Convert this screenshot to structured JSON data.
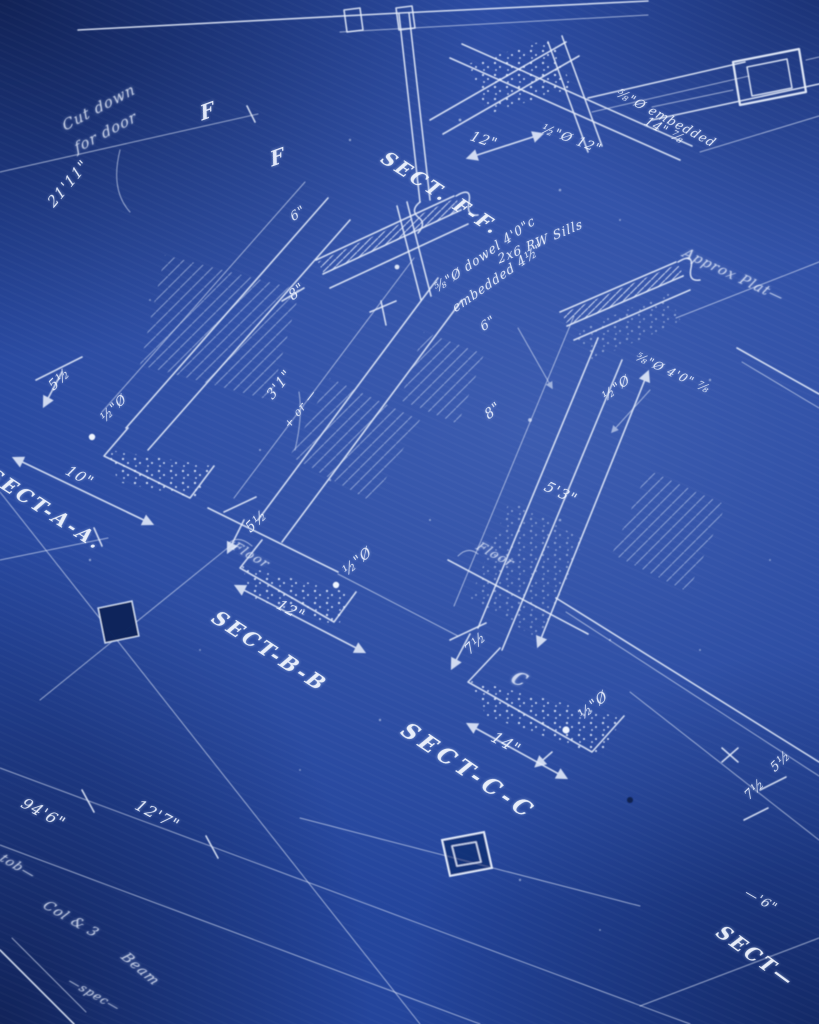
{
  "image": {
    "kind": "photograph of a hand-drawn cyanotype construction blueprint",
    "paper_color": "#24459c",
    "highlight_color": "#3a5cb2",
    "shadow_color": "#12295e",
    "line_color": "#e7eefc"
  },
  "sections": {
    "ff": "SECT. F-F.",
    "aa": "SECT-A-A.",
    "bb": "SECT-B-B",
    "cc": "SECT-C-C",
    "partial": "SECT—"
  },
  "markers": {
    "f1": "F",
    "f2": "F",
    "c": "C"
  },
  "notes": {
    "cut1": "Cut down",
    "cut2": "for door",
    "sills": "2x6 RW Sills",
    "dowel1": "⅝\"Ø dowel 4'0\"c",
    "dowel2": "embedded 4½\"",
    "embed1": "⅝\"Ø embedded",
    "embed2": "14\" ⅞",
    "approx": "Approx Plat—",
    "floor_a": "Floor",
    "floor_c": "Floor",
    "dowel_r": "⅝\"Ø 4'0\" ⅞",
    "script1": "tob—",
    "script2": "Col & 3",
    "script3": "Beam",
    "script4": "—spec—"
  },
  "dimensions": {
    "d21_11": "21'11\"",
    "d12_ff": "12\"",
    "dhalf12_ff": "½\"Ø 12\"",
    "d10": "10\"",
    "d5h_a": "5½",
    "dhalf_a": "½\"Ø",
    "d8_a": "8\"",
    "d3_1": "3'1\"",
    "d3_1b": "+ or —",
    "d6_a": "6\"",
    "d6_b": "6\"",
    "d5h_b": "5½",
    "dhalf_b": "½\"Ø",
    "d12_b": "12\"",
    "d8_c": "8\"",
    "d5_3": "5'3\"",
    "dhalf_r": "½\"Ø",
    "d7h_c": "7½",
    "d14_c": "14\"",
    "dhalf_c": "½\"Ø",
    "d94_6": "94'6\"",
    "d12_7": "12'7\"",
    "d5h_br": "5½",
    "d7h_br": "7½",
    "d6_frag": "—'6\""
  }
}
